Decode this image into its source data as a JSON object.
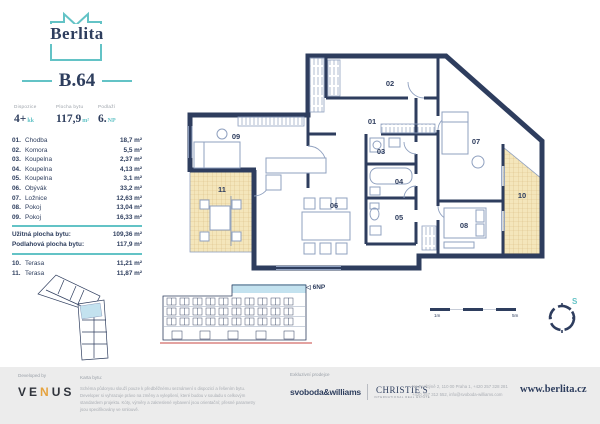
{
  "brand": {
    "name": "Berlita"
  },
  "unit": {
    "code": "B.64",
    "stats": [
      {
        "label": "Dispozice",
        "value": "4+",
        "suffix": "kk"
      },
      {
        "label": "Plocha bytu",
        "value": "117,9",
        "suffix": "m²"
      },
      {
        "label": "Podlaží",
        "value": "6.",
        "suffix": "NP"
      }
    ]
  },
  "rooms": [
    {
      "no": "01.",
      "name": "Chodba",
      "area": "18,7 m²"
    },
    {
      "no": "02.",
      "name": "Komora",
      "area": "5,5 m²"
    },
    {
      "no": "03.",
      "name": "Koupelna",
      "area": "2,37 m²"
    },
    {
      "no": "04.",
      "name": "Koupelna",
      "area": "4,13 m²"
    },
    {
      "no": "05.",
      "name": "Koupelna",
      "area": "3,1 m²"
    },
    {
      "no": "06.",
      "name": "Obývák",
      "area": "33,2 m²"
    },
    {
      "no": "07.",
      "name": "Ložnice",
      "area": "12,63 m²"
    },
    {
      "no": "08.",
      "name": "Pokoj",
      "area": "13,04 m²"
    },
    {
      "no": "09.",
      "name": "Pokoj",
      "area": "16,33 m²"
    }
  ],
  "summary": [
    {
      "label": "Užitná plocha bytu:",
      "value": "109,36 m²"
    },
    {
      "label": "Podlahová plocha bytu:",
      "value": "117,9 m²"
    }
  ],
  "exterior": [
    {
      "no": "10.",
      "name": "Terasa",
      "area": "11,21 m²"
    },
    {
      "no": "11.",
      "name": "Terasa",
      "area": "11,87 m²"
    }
  ],
  "plan": {
    "room_labels": [
      {
        "no": "01",
        "x": 196,
        "y": 78
      },
      {
        "no": "02",
        "x": 214,
        "y": 40
      },
      {
        "no": "03",
        "x": 205,
        "y": 108
      },
      {
        "no": "04",
        "x": 223,
        "y": 138
      },
      {
        "no": "05",
        "x": 223,
        "y": 174
      },
      {
        "no": "06",
        "x": 158,
        "y": 162
      },
      {
        "no": "07",
        "x": 300,
        "y": 98
      },
      {
        "no": "08",
        "x": 288,
        "y": 182
      },
      {
        "no": "09",
        "x": 60,
        "y": 93
      },
      {
        "no": "10",
        "x": 346,
        "y": 152
      },
      {
        "no": "11",
        "x": 46,
        "y": 146
      }
    ],
    "floor_marker": "6NP",
    "north_label": "S",
    "scale": {
      "start": "1m",
      "end": "5m"
    }
  },
  "footer": {
    "developed_by_label": "Developed by",
    "developer_name": {
      "p1": "VE",
      "p2": "N",
      "p3": "US"
    },
    "card_title": "Karta bytu:",
    "card_text": "Schéma půdorysu slouží pouze k předběžnému seznámení s dispozicí a řešením bytu. Developer si vyhrazuje právo na změny a vylepšení, které budou v souladu s celkovým standardem projektu. Kóty, výměry a zakreslené vybavení jsou orientační; přesné parametry jsou specifikovány ve smlouvě.",
    "exclusive_label": "Exkluzivní prodejce",
    "agency1": "svoboda&williams",
    "agency2": "CHRISTIE'S",
    "agency2_sub": "INTERNATIONAL REAL ESTATE",
    "contact_line1": "Na Perštýně 2, 110 00 Praha 1, +420 257 328 281",
    "contact_line2": "+420 257 312 552, info@svoboda-williams.com",
    "website": "www.berlita.cz"
  }
}
